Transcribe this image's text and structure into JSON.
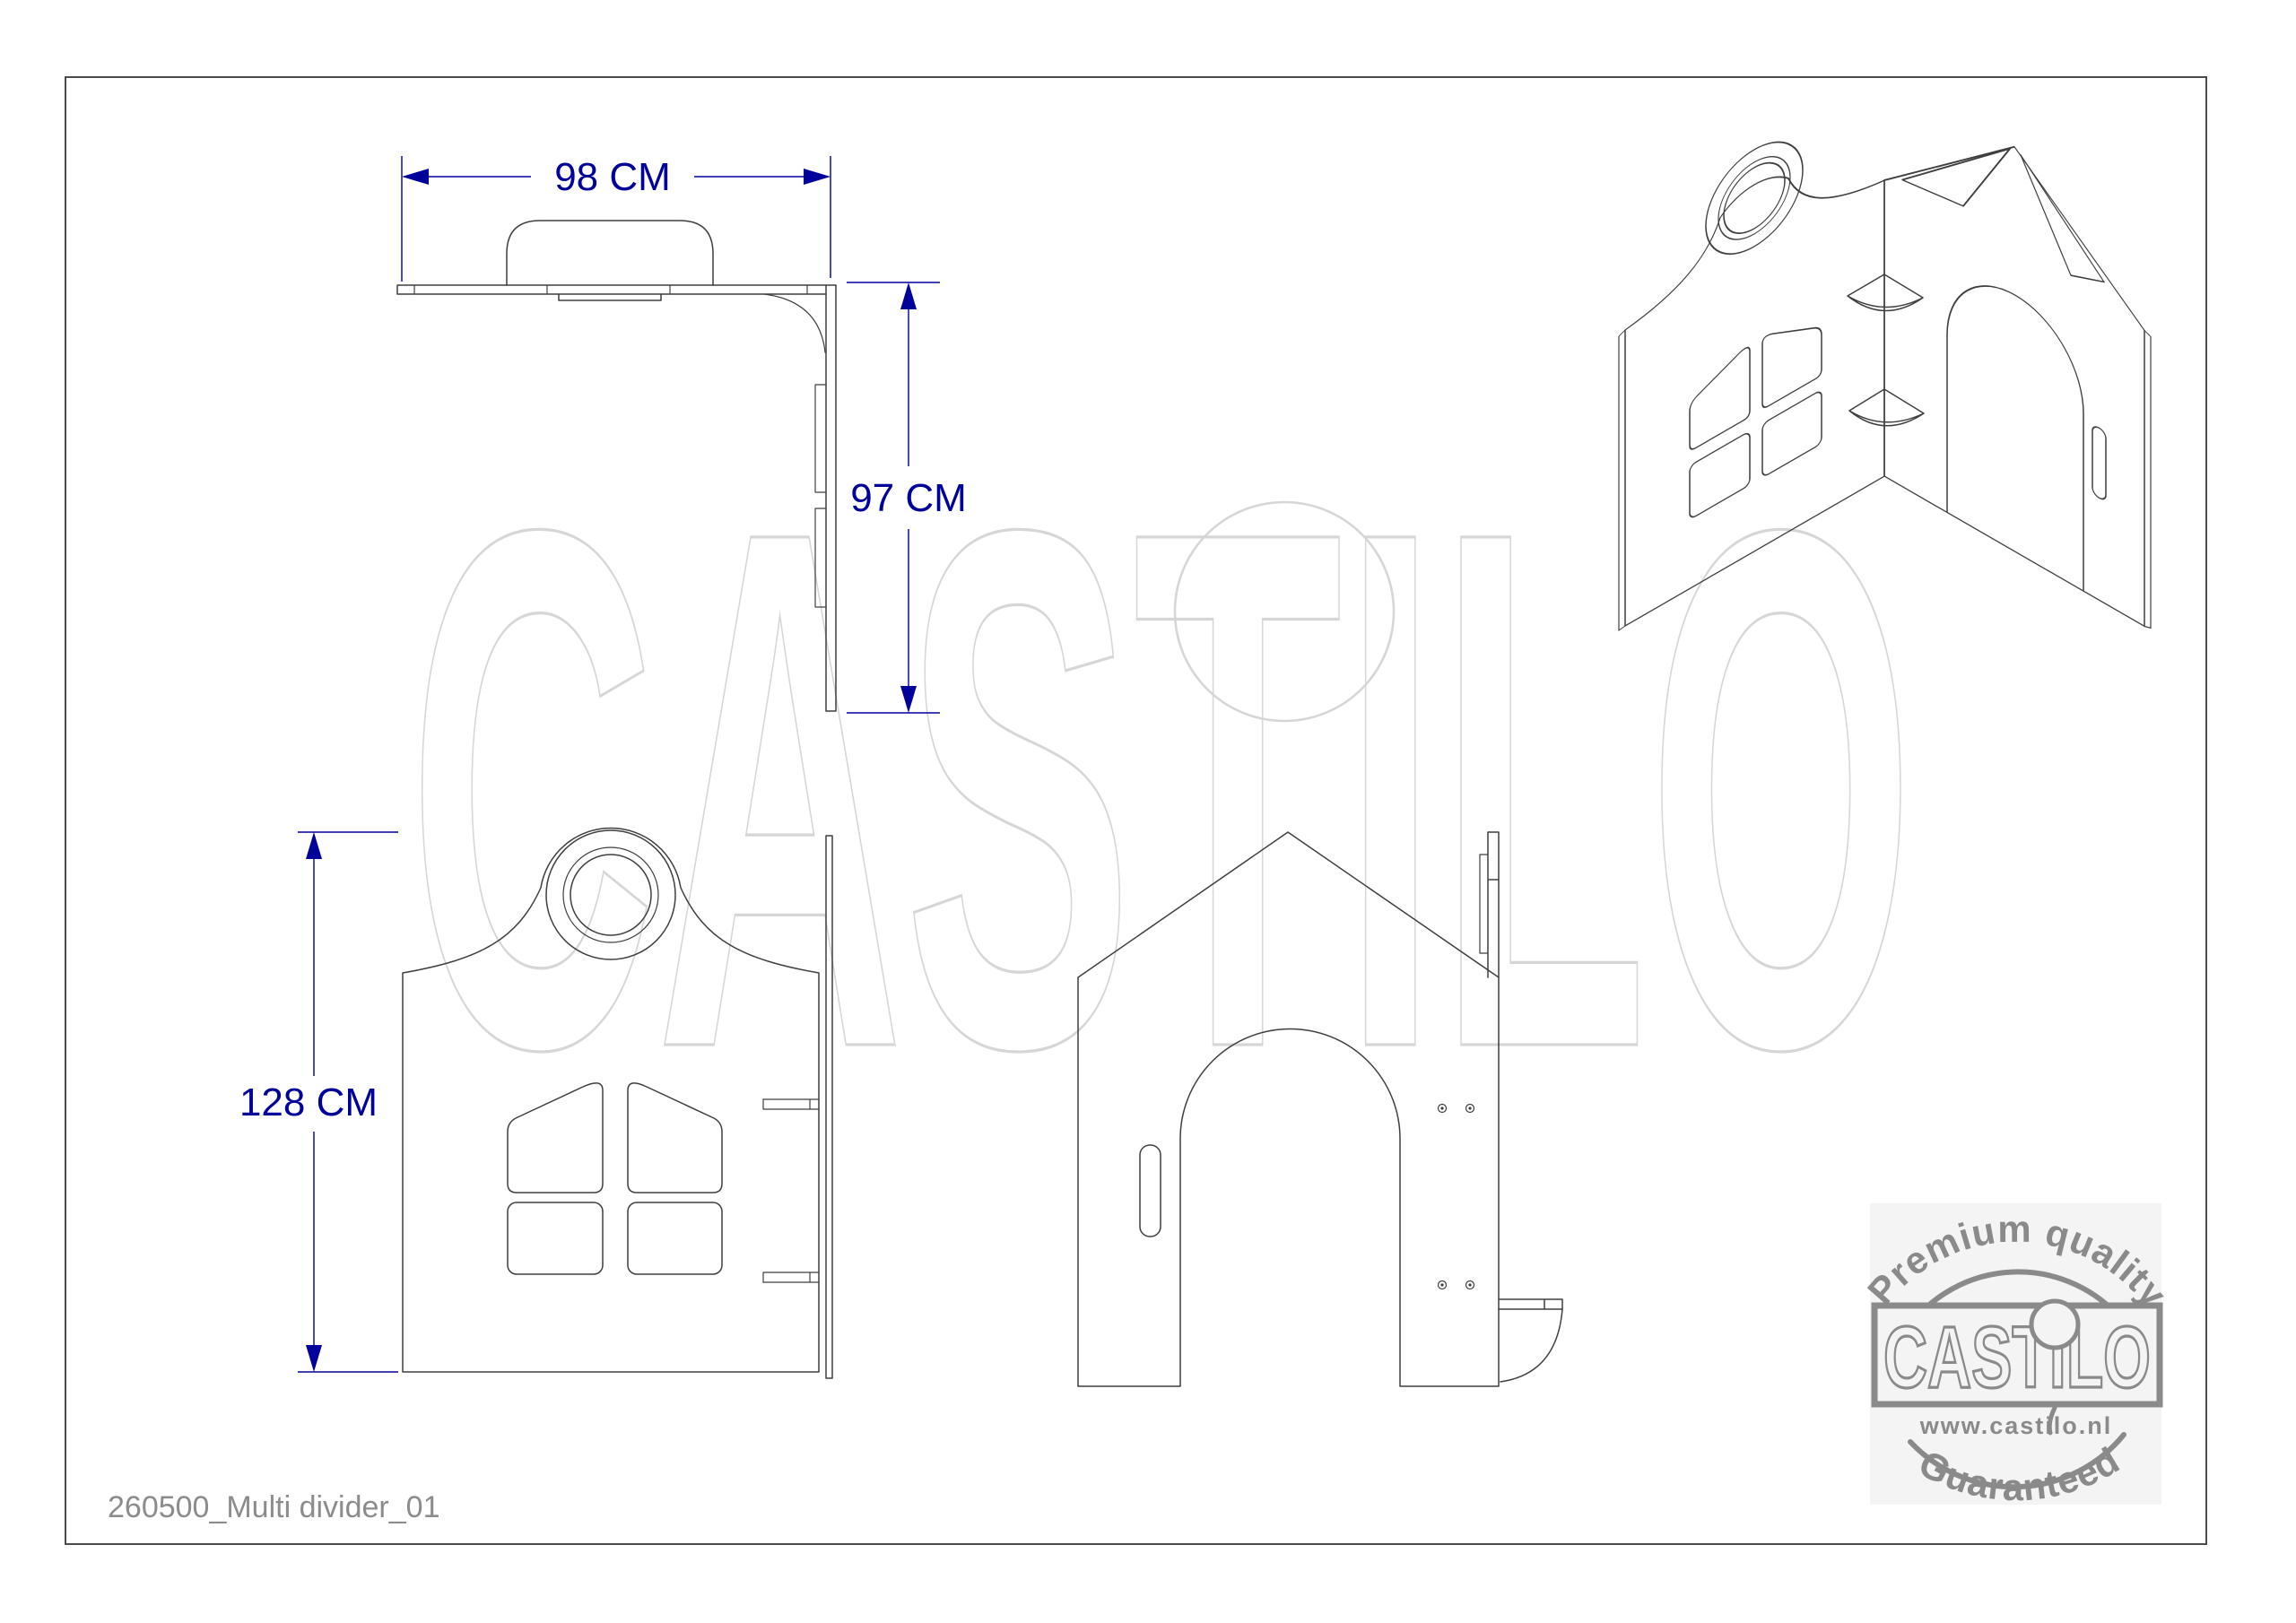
{
  "page": {
    "footer": "260500_Multi divider_01"
  },
  "dimensions": {
    "top_width": "98 CM",
    "side_depth": "97 CM",
    "front_height": "128 CM"
  },
  "watermark": {
    "text": "CASTILO"
  },
  "stamp": {
    "top_text": "Premium quality",
    "brand": "CASTILO",
    "url": "www.castilo.nl",
    "bottom_text": "Guaranteed"
  },
  "colors": {
    "line": "#3f3f3f",
    "dim": "#00009b",
    "wm": "#d6d6d6",
    "stamp": "#8a8a8a",
    "muted": "#8c8c8c",
    "stampbg": "#f4f4f4"
  }
}
